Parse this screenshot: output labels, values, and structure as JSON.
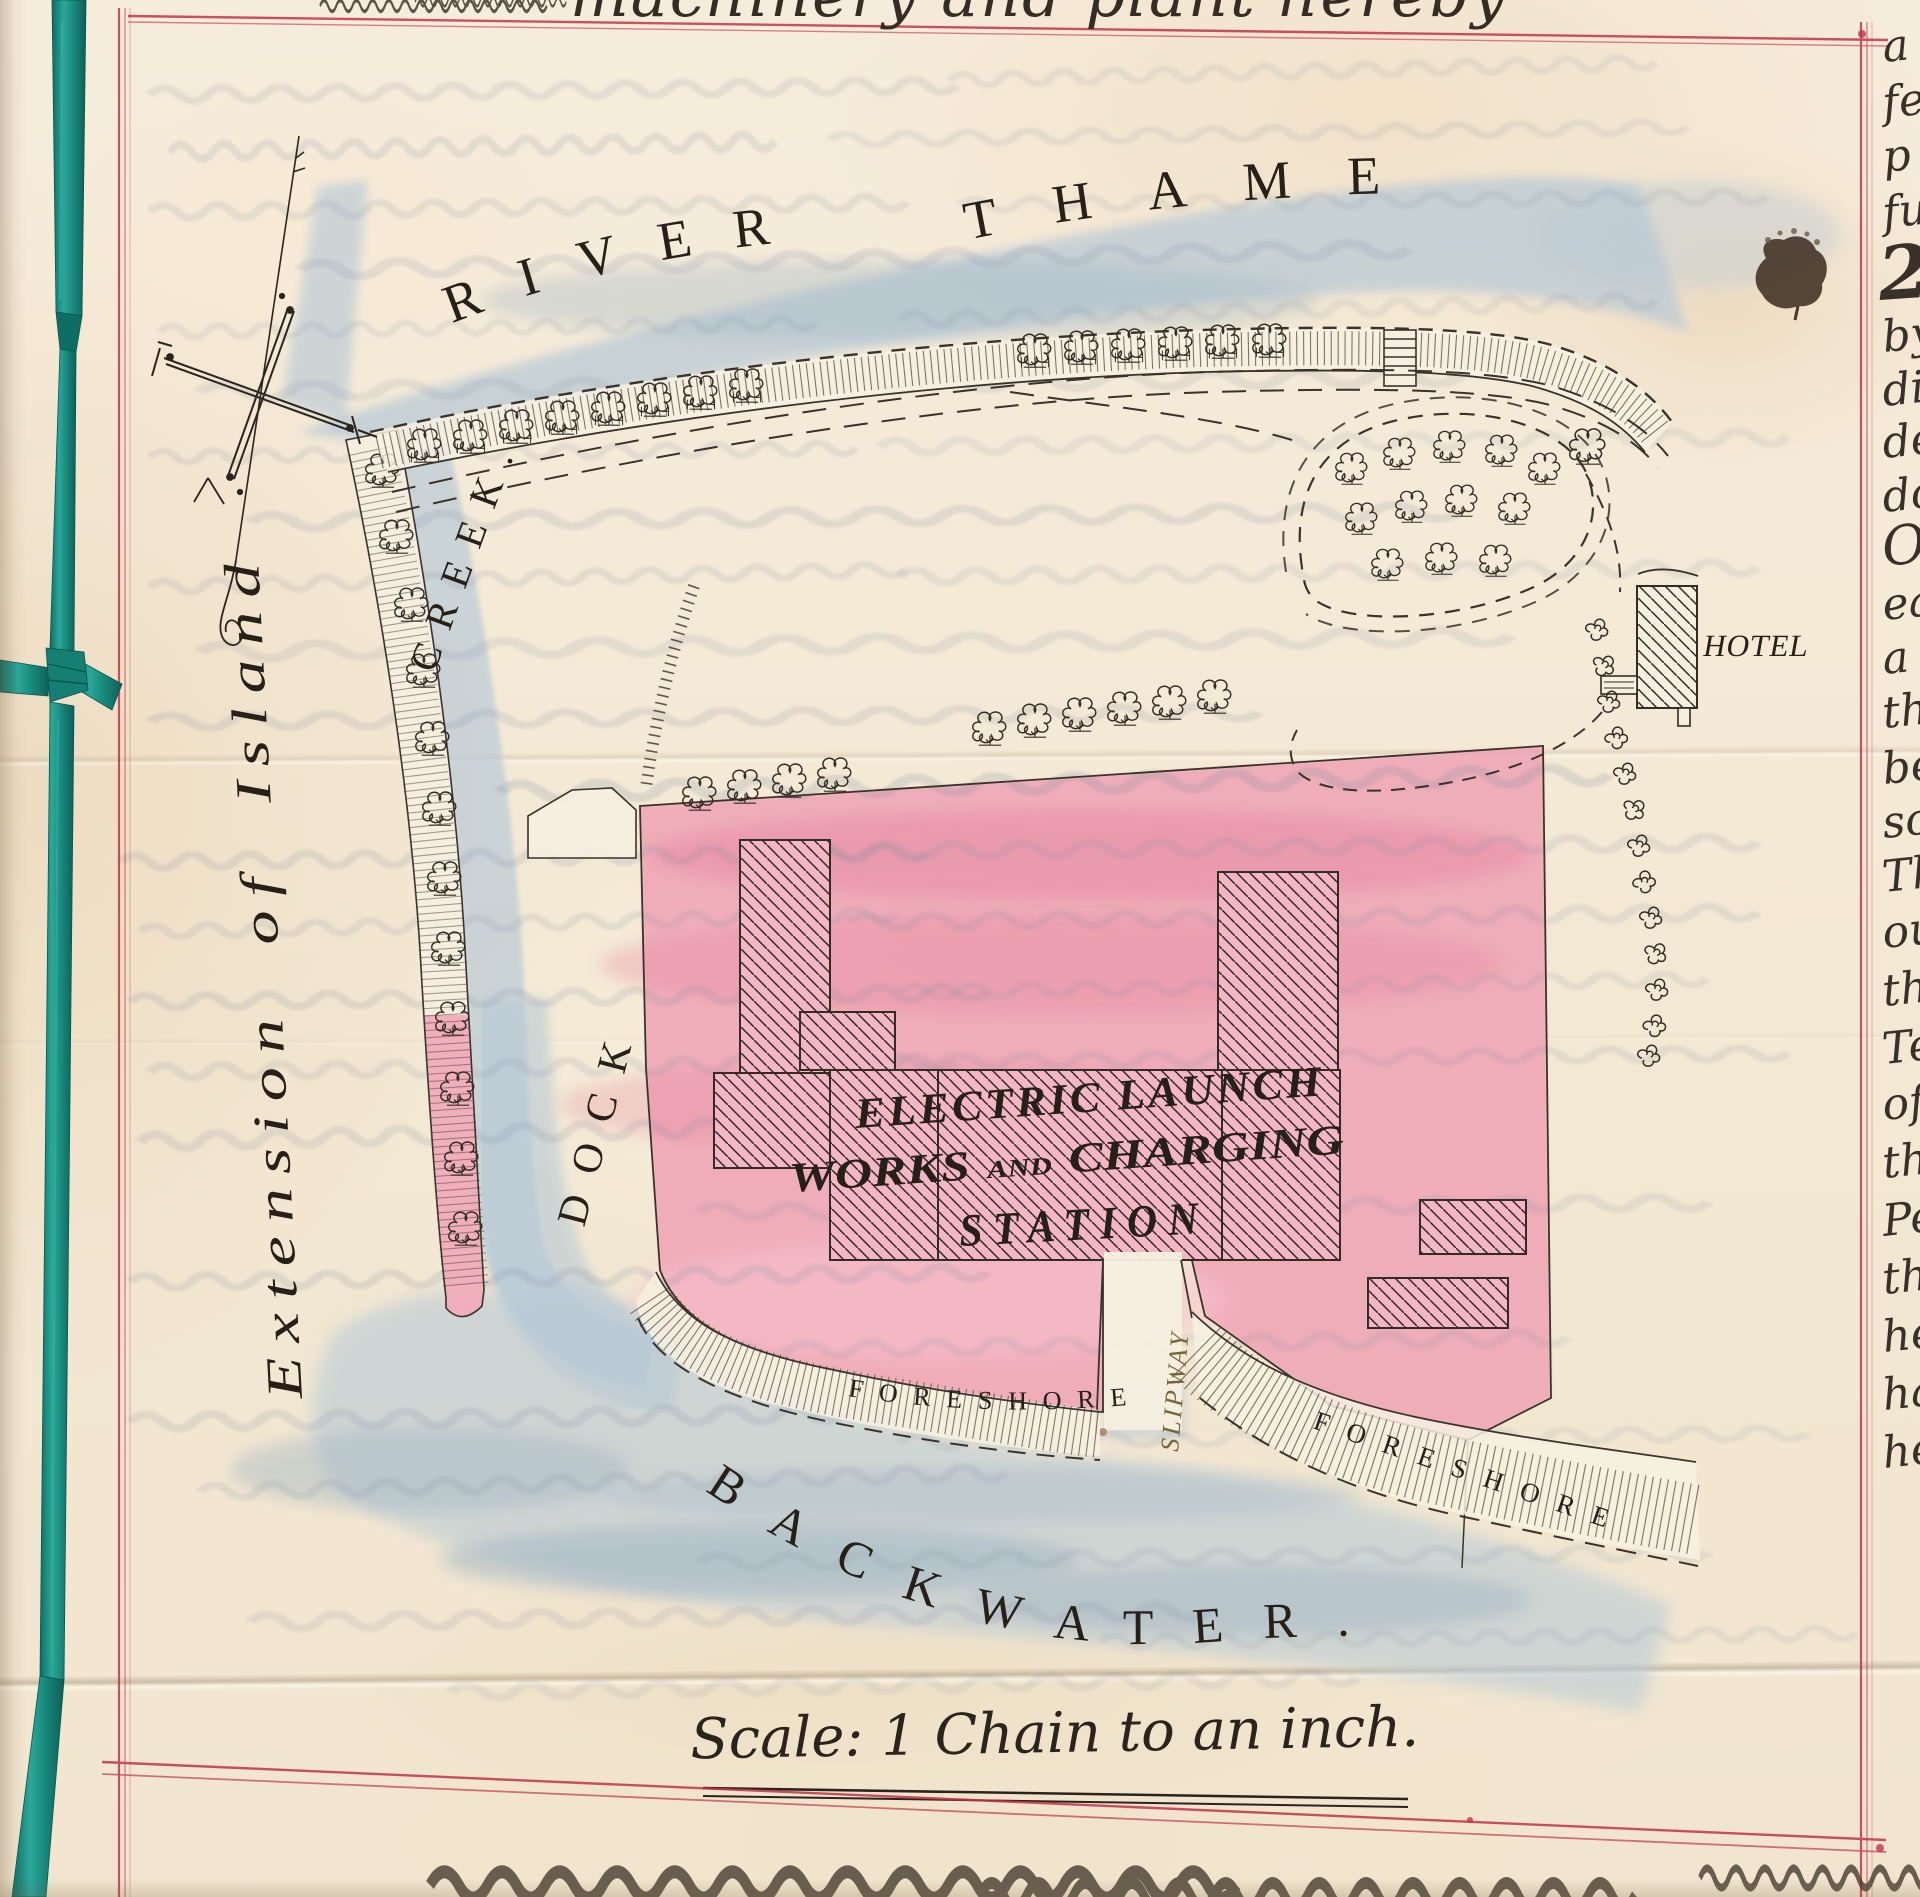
{
  "document_page": {
    "top_handwriting_fragment": "machinery and plant hereby",
    "right_margin_fragments": [
      "a",
      "fe",
      "p",
      "fu",
      "26",
      "by",
      "di",
      "de",
      "do",
      "O",
      "ea",
      "a",
      "th",
      "be",
      "so",
      "Th",
      "ou",
      "th",
      "Te",
      "of",
      "the",
      "Pe",
      "the",
      "he",
      "ha",
      "he"
    ]
  },
  "map": {
    "labels": {
      "river_word1": "RIVER",
      "river_word2": "THAMES",
      "creek": "CREEK.",
      "dock": "DOCK",
      "island_extension": "Extension of Island",
      "hotel": "HOTEL",
      "works_line1": "ELECTRIC LAUNCH",
      "works_word_works": "WORKS",
      "works_word_and": "AND",
      "works_word_charging": "CHARGING",
      "works_line3": "STATION",
      "foreshore_left": "FORESHORE",
      "foreshore_right": "FORESHORE",
      "slipway": "SLIPWAY",
      "backwater": "BACKWATER."
    },
    "scale_caption": "Scale: 1 Chain to an inch.",
    "colors": {
      "water_wash": "#b7c9d6",
      "parcel_wash": "#ef9fb3",
      "ruled_border_red": "#c23349",
      "ribbon_teal": "#1f968a",
      "map_ink": "#3a332b",
      "label_ink": "#262019",
      "slipway_ink": "#756538"
    }
  }
}
